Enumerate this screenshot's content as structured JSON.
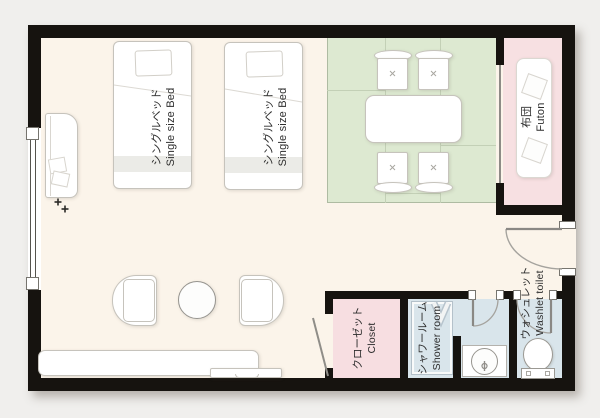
{
  "floorplan": {
    "labels": {
      "bed": {
        "ja": "シングルベッド",
        "en": "Single size Bed"
      },
      "futon": {
        "ja": "布団",
        "en": "Futon"
      },
      "closet": {
        "ja": "クローゼット",
        "en": "Closet"
      },
      "shower": {
        "ja": "シャワールーム",
        "en": "Shower room"
      },
      "toilet": {
        "ja": "ウォシュレット",
        "en": "Washlet toilet"
      }
    },
    "colors": {
      "background": "#f0efed",
      "wall": "#16130f",
      "floor": "#fbf4ea",
      "tatami_green": "#dde9d1",
      "futon_pink": "#f7e0e2",
      "closet_pink": "#f7dee1",
      "bathroom_blue": "#d9e5eb",
      "furniture_outline": "#c6c3bc",
      "door_arc_gray": "#a5a39e",
      "label_text": "#2d2d2d"
    }
  }
}
